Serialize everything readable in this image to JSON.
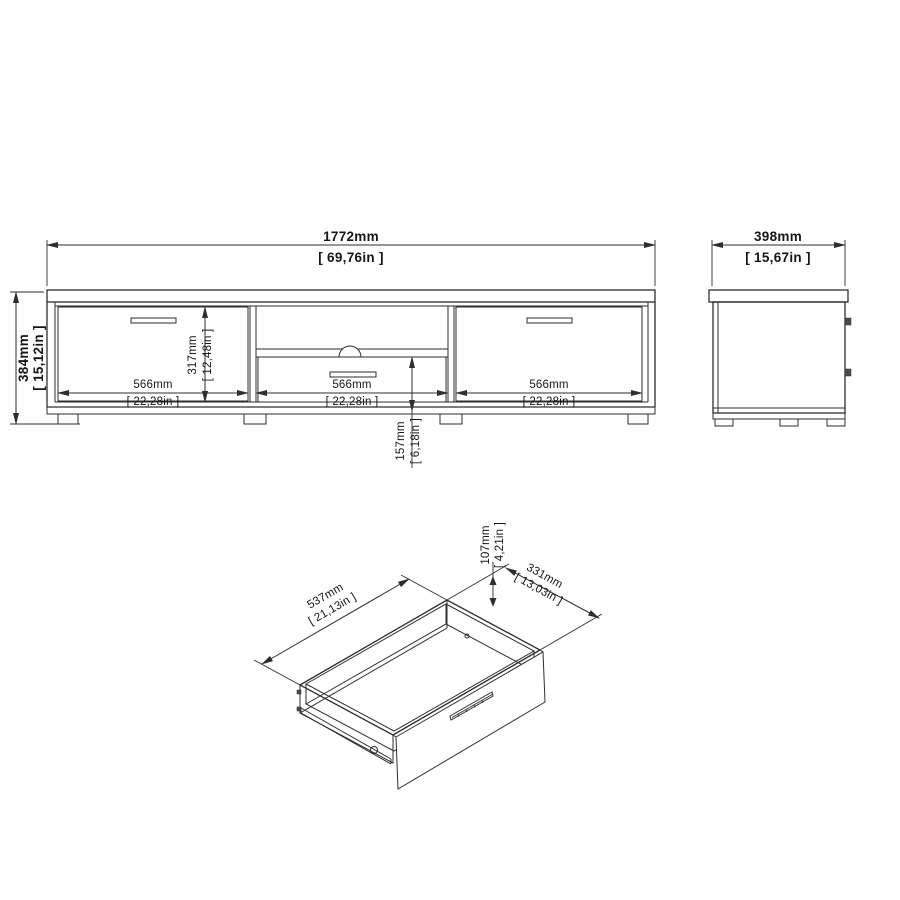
{
  "drawing": {
    "front_view": {
      "width_mm": "1772mm",
      "width_in": "[ 69,76in ]",
      "height_mm": "384mm",
      "height_in": "[ 15,12in ]",
      "inner_height_mm": "317mm",
      "inner_height_in": "[ 12,48in ]",
      "drawer_front_mm": "157mm",
      "drawer_front_in": "[ 6,18in ]",
      "section1_mm": "566mm",
      "section1_in": "[ 22,28in ]",
      "section2_mm": "566mm",
      "section2_in": "[ 22,28in ]",
      "section3_mm": "566mm",
      "section3_in": "[ 22,28in ]"
    },
    "side_view": {
      "depth_mm": "398mm",
      "depth_in": "[ 15,67in ]"
    },
    "drawer_view": {
      "length_mm": "537mm",
      "length_in": "[ 21,13in ]",
      "depth_mm": "331mm",
      "depth_in": "[ 13,03in ]",
      "height_mm": "107mm",
      "height_in": "[ 4,21in ]"
    },
    "line_color": "#2e2e2e",
    "background_color": "#ffffff"
  }
}
